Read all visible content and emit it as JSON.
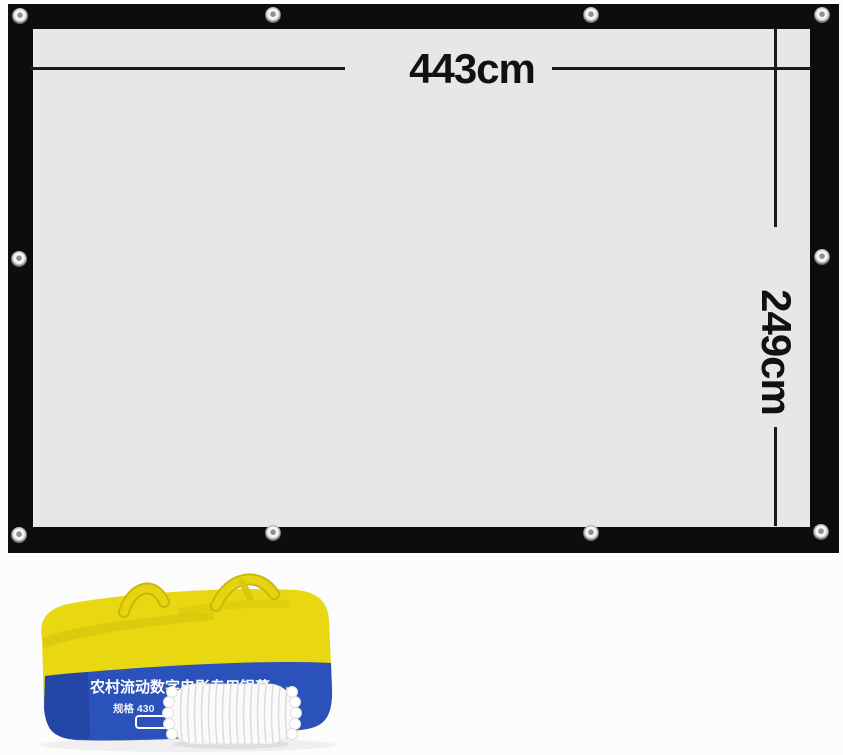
{
  "annotations": {
    "width_label": "443cm",
    "height_label": "249cm"
  },
  "bag": {
    "title": "农村流动数字电影专用银幕",
    "spec_left": "规格 430",
    "spec_right": "cm"
  },
  "colors": {
    "background": "#fcfcfc",
    "frame_black": "#0d0d0d",
    "screen_surface": "#e7e7e7",
    "dimension_line": "#1a1a1a",
    "bag_yellow": "#e9d712",
    "bag_blue": "#2b52ba",
    "bag_text_white": "#ffffff",
    "rope_white": "#fbfbfb"
  }
}
